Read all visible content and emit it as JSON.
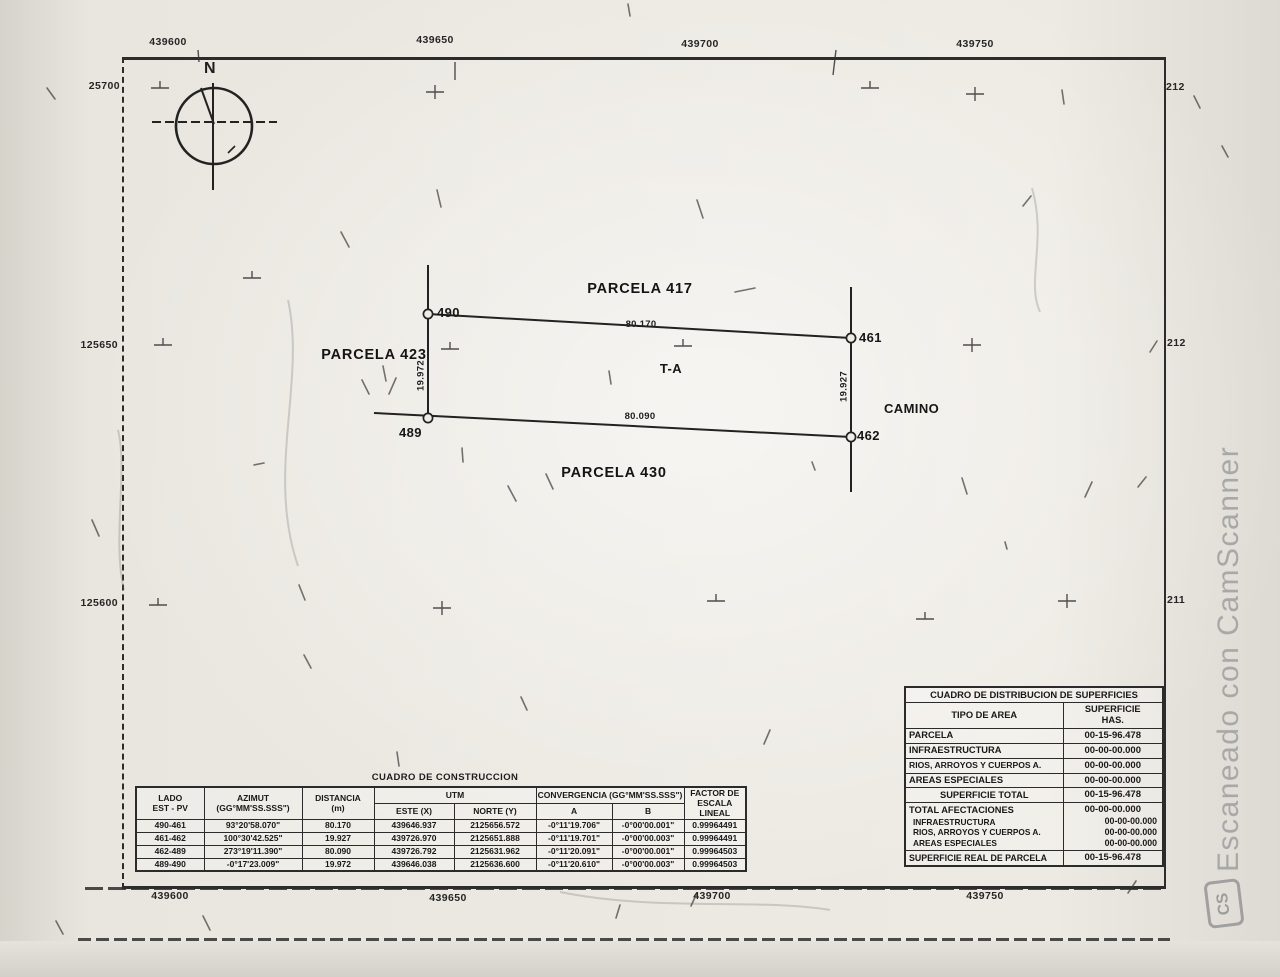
{
  "watermark": {
    "text": "Escaneado con CamScanner",
    "logo": "CS"
  },
  "map": {
    "north": "N",
    "grid": {
      "top": [
        "439600",
        "439650",
        "439700",
        "439750"
      ],
      "bottom": [
        "439600",
        "439650",
        "439700",
        "439750"
      ],
      "left": [
        "25700",
        "125650",
        "125600"
      ],
      "right": [
        "212",
        "212",
        "211"
      ]
    },
    "parcel": {
      "neighbors": {
        "top": "PARCELA 417",
        "left": "PARCELA 423",
        "bottom": "PARCELA 430",
        "right": "CAMINO"
      },
      "lot": "T-A",
      "vertices": {
        "nw": "490",
        "ne": "461",
        "sw": "489",
        "se": "462"
      },
      "sides": {
        "top": "80.170",
        "bottom": "80.090",
        "left": "19.972",
        "right": "19.927"
      }
    }
  },
  "construction_table": {
    "title": "CUADRO DE CONSTRUCCION",
    "headers": {
      "lado1": "LADO",
      "lado2": "EST - PV",
      "azimut1": "AZIMUT",
      "azimut2": "(GG°MM'SS.SSS\")",
      "dist1": "DISTANCIA",
      "dist2": "(m)",
      "utm": "UTM",
      "este": "ESTE (X)",
      "norte": "NORTE (Y)",
      "conv": "CONVERGENCIA (GG°MM'SS.SSS\")",
      "a": "A",
      "b": "B",
      "factor1": "FACTOR DE",
      "factor2": "ESCALA LINEAL"
    },
    "rows": [
      {
        "lado": "490-461",
        "azimut": "93°20'58.070\"",
        "dist": "80.170",
        "este": "439646.937",
        "norte": "2125656.572",
        "a": "-0°11'19.706\"",
        "b": "-0°00'00.001\"",
        "factor": "0.99964491"
      },
      {
        "lado": "461-462",
        "azimut": "100°30'42.525\"",
        "dist": "19.927",
        "este": "439726.970",
        "norte": "2125651.888",
        "a": "-0°11'19.701\"",
        "b": "-0°00'00.003\"",
        "factor": "0.99964491"
      },
      {
        "lado": "462-489",
        "azimut": "273°19'11.390\"",
        "dist": "80.090",
        "este": "439726.792",
        "norte": "2125631.962",
        "a": "-0°11'20.091\"",
        "b": "-0°00'00.001\"",
        "factor": "0.99964503"
      },
      {
        "lado": "489-490",
        "azimut": "-0°17'23.009\"",
        "dist": "19.972",
        "este": "439646.038",
        "norte": "2125636.600",
        "a": "-0°11'20.610\"",
        "b": "-0°00'00.003\"",
        "factor": "0.99964503"
      }
    ]
  },
  "surfaces_table": {
    "title": "CUADRO DE DISTRIBUCION DE SUPERFICIES",
    "headers": {
      "tipo": "TIPO DE AREA",
      "sup1": "SUPERFICIE",
      "sup2": "HAS."
    },
    "rows": [
      {
        "label": "PARCELA",
        "value": "00-15-96.478"
      },
      {
        "label": "INFRAESTRUCTURA",
        "value": "00-00-00.000"
      },
      {
        "label": "RIOS, ARROYOS Y CUERPOS A.",
        "value": "00-00-00.000"
      },
      {
        "label": "AREAS ESPECIALES",
        "value": "00-00-00.000"
      }
    ],
    "total_row": {
      "label": "SUPERFICIE TOTAL",
      "value": "00-15-96.478"
    },
    "afectaciones": {
      "label": "TOTAL AFECTACIONES",
      "value": "00-00-00.000",
      "sub": [
        {
          "label": "INFRAESTRUCTURA",
          "value": "00-00-00.000"
        },
        {
          "label": "RIOS, ARROYOS Y CUERPOS A.",
          "value": "00-00-00.000"
        },
        {
          "label": "AREAS ESPECIALES",
          "value": "00-00-00.000"
        }
      ]
    },
    "final_row": {
      "label": "SUPERFICIE REAL DE PARCELA",
      "value": "00-15-96.478"
    }
  }
}
